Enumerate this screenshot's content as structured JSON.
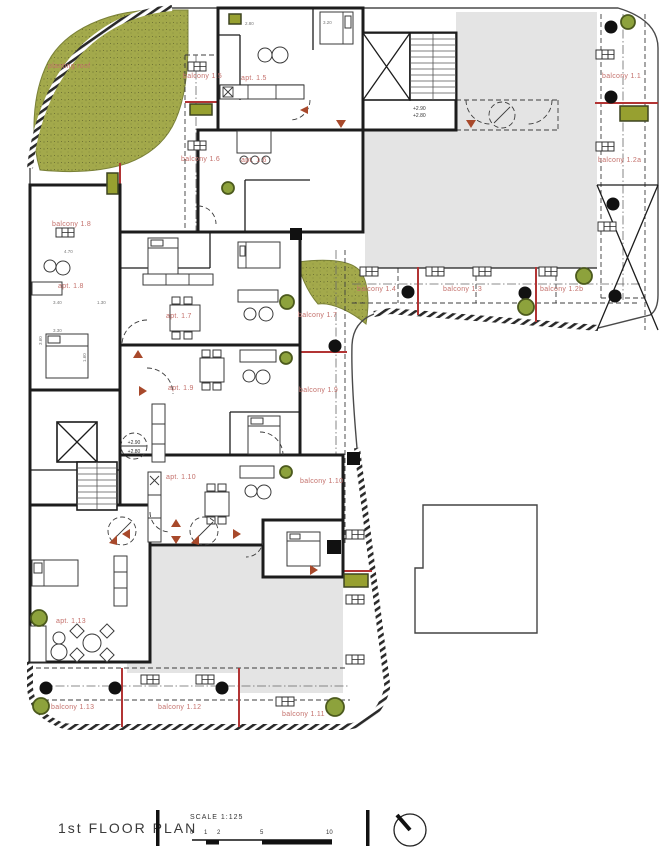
{
  "drawing": {
    "title": "1st FLOOR PLAN",
    "scale": {
      "label": "SCALE 1:125",
      "ticks": [
        "0",
        "1",
        "2",
        "5",
        "10"
      ]
    },
    "planting_roof_label": "planting roof",
    "levels": {
      "upper": "+2.90",
      "lower": "+2.80"
    }
  },
  "apartments": [
    {
      "label": "apt. 1.5"
    },
    {
      "label": "apt. 1.6"
    },
    {
      "label": "apt. 1.7"
    },
    {
      "label": "apt. 1.8"
    },
    {
      "label": "apt. 1.9"
    },
    {
      "label": "apt. 1.10"
    },
    {
      "label": "apt. 1.13"
    }
  ],
  "balconies": [
    {
      "label": "balcony 1.1"
    },
    {
      "label": "balcony 1.2a"
    },
    {
      "label": "balcony 1.2b"
    },
    {
      "label": "balcony 1.3"
    },
    {
      "label": "balcony 1.4"
    },
    {
      "label": "balcony 1.5"
    },
    {
      "label": "balcony 1.6"
    },
    {
      "label": "balcony 1.7"
    },
    {
      "label": "balcony 1.8"
    },
    {
      "label": "balcony 1.9"
    },
    {
      "label": "balcony 1.10"
    },
    {
      "label": "balcony 1.11"
    },
    {
      "label": "balcony 1.12"
    },
    {
      "label": "balcony 1.13"
    }
  ],
  "dimensions": [
    "2.80",
    "3.20",
    "4.70",
    "3.40",
    "1.30",
    "3.30",
    "3.60",
    "1.60"
  ],
  "colors": {
    "label_red": "#c4716c",
    "arrow_red": "#a8492b",
    "divider_red": "#b23434",
    "planting_green": "#a3a94b",
    "planter_green": "#8da23c",
    "roof_gray": "#e4e4e4",
    "wall_dark": "#1c1c1c"
  }
}
